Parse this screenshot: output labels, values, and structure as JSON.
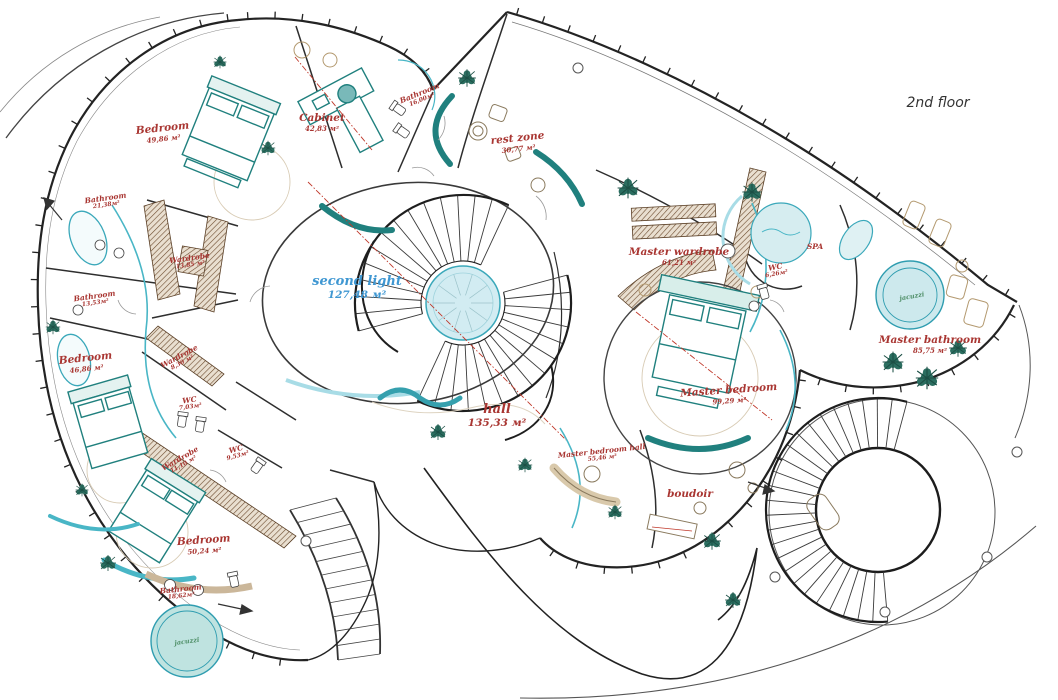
{
  "title": "2nd floor",
  "palette": {
    "red": "#a93632",
    "blue": "#3f97d2",
    "green": "#4f8f68",
    "wall": "#232323",
    "teal": "#20807e",
    "cyan": "#49b6c6",
    "tan": "#c4ae8c",
    "brown": "#6d4c2f",
    "water": "#cfe9ee"
  },
  "rooms": [
    {
      "label": "Bedroom",
      "area": "49,86 м²",
      "x": 163,
      "y": 133,
      "cls": "lg red",
      "rot": -6
    },
    {
      "label": "Cabinet",
      "area": "42,83 м²",
      "x": 322,
      "y": 123,
      "cls": "lg red",
      "rot": 0
    },
    {
      "label": "Bathroom",
      "area": "16,00м²",
      "x": 421,
      "y": 97,
      "cls": "sm red",
      "rot": -22
    },
    {
      "label": "rest zone",
      "area": "30,77 м²",
      "x": 518,
      "y": 143,
      "cls": "lg red",
      "rot": -6
    },
    {
      "label": "Bathroom",
      "area": "21,38м²",
      "x": 106,
      "y": 202,
      "cls": "sm red",
      "rot": -8
    },
    {
      "label": "Wardrobe",
      "area": "13,85 м²",
      "x": 190,
      "y": 262,
      "cls": "sm red",
      "rot": -8
    },
    {
      "label": "Bathroom",
      "area": "13,53м²",
      "x": 95,
      "y": 300,
      "cls": "sm red",
      "rot": -8
    },
    {
      "label": "Bedroom",
      "area": "46,86 м²",
      "x": 86,
      "y": 363,
      "cls": "lg red",
      "rot": -6
    },
    {
      "label": "Wardrobe",
      "area": "8,30 м²",
      "x": 181,
      "y": 360,
      "cls": "sm red",
      "rot": -28
    },
    {
      "label": "WC",
      "area": "7,03м²",
      "x": 190,
      "y": 404,
      "cls": "sm red",
      "rot": -8
    },
    {
      "label": "Wardrobe",
      "area": "11,10 м²",
      "x": 182,
      "y": 462,
      "cls": "sm red",
      "rot": -30
    },
    {
      "label": "WC",
      "area": "9,53м²",
      "x": 237,
      "y": 453,
      "cls": "sm red",
      "rot": -15
    },
    {
      "label": "Bedroom",
      "area": "50,24 м²",
      "x": 204,
      "y": 545,
      "cls": "lg red",
      "rot": -4
    },
    {
      "label": "Bathroom",
      "area": "18,62м²",
      "x": 181,
      "y": 593,
      "cls": "sm red",
      "rot": -6
    },
    {
      "label": "jacuzzi",
      "area": "",
      "x": 187,
      "y": 642,
      "cls": "green",
      "rot": -8
    },
    {
      "label": "second light",
      "area": "127,48 м²",
      "x": 357,
      "y": 288,
      "cls": "xl blue",
      "rot": 0
    },
    {
      "label": "hall",
      "area": "135,33 м²",
      "x": 497,
      "y": 416,
      "cls": "xl red",
      "rot": 0
    },
    {
      "label": "Master wardrobe",
      "area": "61,21 м²",
      "x": 679,
      "y": 257,
      "cls": "lg red",
      "rot": 0
    },
    {
      "label": "WC",
      "area": "6,26м²",
      "x": 776,
      "y": 271,
      "cls": "sm red",
      "rot": -10
    },
    {
      "label": "SPA",
      "area": "",
      "x": 815,
      "y": 247,
      "cls": "sm red",
      "rot": 0
    },
    {
      "label": "Master bedroom",
      "area": "99,29 м²",
      "x": 729,
      "y": 395,
      "cls": "lg red",
      "rot": -4
    },
    {
      "label": "Master bathroom",
      "area": "85,75 м²",
      "x": 930,
      "y": 345,
      "cls": "lg red",
      "rot": 0
    },
    {
      "label": "jacuzzi",
      "area": "",
      "x": 912,
      "y": 297,
      "cls": "green",
      "rot": -10
    },
    {
      "label": "Master bedroom hall",
      "area": "55,46 м²",
      "x": 602,
      "y": 455,
      "cls": "sm red",
      "rot": -6
    },
    {
      "label": "boudoir",
      "area": "",
      "x": 690,
      "y": 495,
      "cls": "lg red",
      "rot": 0
    }
  ]
}
